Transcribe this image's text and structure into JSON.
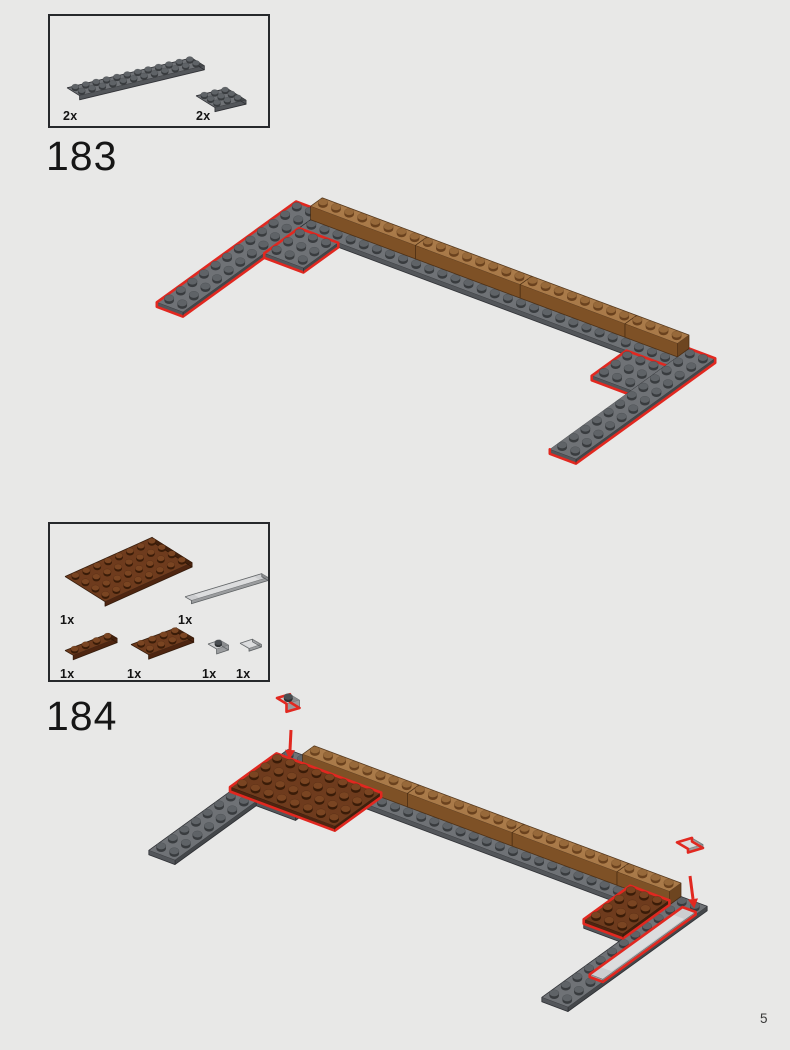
{
  "page": {
    "number": "5",
    "background": "#e8e8e7"
  },
  "steps": [
    {
      "number": "183",
      "parts": [
        {
          "count": "2x",
          "part": "plate-2x12-dark-gray"
        },
        {
          "count": "2x",
          "part": "plate-3x3-dark-gray"
        }
      ]
    },
    {
      "number": "184",
      "parts": [
        {
          "count": "1x",
          "part": "plate-4x8-reddish-brown"
        },
        {
          "count": "1x",
          "part": "tile-1x8-light-gray"
        },
        {
          "count": "1x",
          "part": "plate-1x4-reddish-brown"
        },
        {
          "count": "1x",
          "part": "plate-2x4-reddish-brown"
        },
        {
          "count": "1x",
          "part": "plate-1x1-light-gray"
        },
        {
          "count": "1x",
          "part": "tile-1x1-light-gray"
        }
      ]
    }
  ],
  "colors": {
    "red_outline": "#e12820",
    "background": "#e8e8e7",
    "text": "#161616",
    "box_border": "#26282b",
    "bricks": {
      "dg": {
        "top": "#6f7276",
        "sw": "#53565a",
        "se": "#44474a",
        "studSide": "#393c3f",
        "studTop": "#5f6367",
        "edge": "#24262a"
      },
      "ng": {
        "top": "#a97a49",
        "sw": "#7e5126",
        "se": "#6d4520",
        "studSide": "#6b421e",
        "studTop": "#97693a",
        "edge": "#492c12"
      },
      "rb": {
        "top": "#6e3b1d",
        "sw": "#4e2510",
        "se": "#41200c",
        "studSide": "#3a1c08",
        "studTop": "#7a4522",
        "edge": "#2b1405"
      },
      "lg": {
        "top": "#cdced0",
        "sw": "#9a9c9e",
        "se": "#8a8c8e",
        "studSide": "#8e9092",
        "studTop": "#c3c5c7",
        "edge": "#54575a"
      },
      "darkStud": {
        "side": "#2e3133",
        "top": "#4a4e52"
      }
    }
  },
  "scenes": {
    "box183": {
      "o": [
        17,
        76
      ],
      "U": [
        10.4,
        -2.5
      ],
      "V": [
        6.3,
        3.9
      ],
      "ph": 4.2,
      "studR": [
        3.6,
        2.6
      ],
      "studH": 1.9,
      "pieces": [
        {
          "box": [
            0,
            0,
            12,
            2,
            0,
            1
          ],
          "c": "dg",
          "studs": [
            [
              0,
              0,
              11,
              1
            ]
          ]
        },
        {
          "box": [
            0,
            0,
            3,
            3,
            0,
            1
          ],
          "c": "dg",
          "o": [
            146,
            84
          ],
          "studs": [
            [
              0,
              0,
              2,
              2
            ]
          ]
        }
      ]
    },
    "box184": {
      "o": [
        15,
        57
      ],
      "U": [
        10.9,
        -4.9
      ],
      "V": [
        10,
        6.3
      ],
      "ph": 4.5,
      "studR": [
        3.8,
        2.8
      ],
      "studH": 2,
      "pieces": [
        {
          "box": [
            0,
            0,
            8,
            4,
            0,
            1
          ],
          "c": "rb",
          "studs": [
            [
              0,
              0,
              7,
              3
            ]
          ]
        },
        {
          "box": [
            0,
            0,
            8,
            1,
            0,
            0.7
          ],
          "c": "lg",
          "o": [
            135,
            76
          ],
          "U": [
            9.6,
            -2.9
          ],
          "V": [
            6.4,
            3.7
          ],
          "smooth": true
        },
        {
          "box": [
            0,
            0,
            4,
            1,
            0,
            1
          ],
          "c": "rb",
          "o": [
            15,
            131
          ],
          "U": [
            11,
            -4.3
          ],
          "V": [
            8.2,
            4.8
          ],
          "studs": [
            [
              0,
              0,
              3,
              0
            ]
          ]
        },
        {
          "box": [
            0,
            0,
            4,
            2,
            0,
            1
          ],
          "c": "rb",
          "o": [
            81,
            125
          ],
          "U": [
            11.3,
            -4.2
          ],
          "V": [
            8.8,
            5.1
          ],
          "studs": [
            [
              0,
              0,
              3,
              1
            ]
          ]
        },
        {
          "box": [
            0,
            0,
            1,
            1,
            0,
            1
          ],
          "c": "lg",
          "o": [
            158,
            125
          ],
          "U": [
            12,
            -4
          ],
          "V": [
            8.6,
            5
          ],
          "ph": 5,
          "studs": [
            [
              0,
              0,
              0,
              0
            ]
          ],
          "studC": "dark",
          "studR": [
            3.6,
            2.6
          ],
          "studH": 2.2
        },
        {
          "box": [
            0,
            0,
            1,
            1,
            0,
            0.6
          ],
          "c": "lg",
          "o": [
            190,
            122
          ],
          "U": [
            12.5,
            -4.2
          ],
          "V": [
            9,
            5.2
          ],
          "smooth": true
        }
      ]
    },
    "a183": {
      "o": [
        156,
        21
      ],
      "U": [
        13.1,
        4.9
      ],
      "V": [
        -11.6,
        8.4
      ],
      "ph": 4.5,
      "studR": [
        4.8,
        3.4
      ],
      "studH": 2.4,
      "pieces": [
        {
          "box": [
            0,
            0,
            2,
            12,
            0,
            1
          ],
          "c": "dg",
          "red": true,
          "studs": [
            [
              0,
              0,
              1,
              11
            ]
          ]
        },
        {
          "box": [
            2,
            0,
            30,
            2,
            0,
            1
          ],
          "c": "dg",
          "studs": [
            [
              2,
              1,
              29,
              1
            ]
          ]
        },
        {
          "box": [
            2,
            2,
            5,
            5,
            0,
            1
          ],
          "c": "dg",
          "red": true,
          "studs": [
            [
              2,
              2,
              4,
              4
            ]
          ]
        },
        {
          "box": [
            27,
            2,
            30,
            5,
            0,
            1
          ],
          "c": "dg",
          "red": true,
          "studs": [
            [
              27,
              2,
              29,
              4
            ]
          ]
        },
        {
          "box": [
            30,
            0,
            32,
            12,
            0,
            1
          ],
          "c": "dg",
          "red": true,
          "openSil": true,
          "studs": [
            [
              30,
              0,
              31,
              11
            ]
          ]
        },
        {
          "box": [
            2,
            0,
            10,
            1,
            1,
            4
          ],
          "c": "ng",
          "studs": [
            [
              2,
              0,
              9,
              0
            ]
          ]
        },
        {
          "box": [
            10,
            0,
            18,
            1,
            1,
            4
          ],
          "c": "ng",
          "studs": [
            [
              10,
              0,
              17,
              0
            ]
          ]
        },
        {
          "box": [
            18,
            0,
            26,
            1,
            1,
            4
          ],
          "c": "ng",
          "studs": [
            [
              18,
              0,
              25,
              0
            ]
          ]
        },
        {
          "box": [
            26,
            0,
            30,
            1,
            1,
            4
          ],
          "c": "ng",
          "studs": [
            [
              26,
              0,
              29,
              0
            ]
          ]
        }
      ]
    },
    "a184": {
      "o": [
        148,
        66
      ],
      "U": [
        13.1,
        4.9
      ],
      "V": [
        -11.6,
        8.4
      ],
      "ph": 4.5,
      "studR": [
        4.8,
        3.4
      ],
      "studH": 2.4,
      "pieces": [
        {
          "box": [
            0,
            0,
            2,
            12,
            0,
            1
          ],
          "c": "dg",
          "studs": [
            [
              0,
              0,
              1,
              11
            ]
          ]
        },
        {
          "box": [
            2,
            0,
            30,
            2,
            0,
            1
          ],
          "c": "dg",
          "studs": [
            [
              2,
              1,
              29,
              1
            ]
          ]
        },
        {
          "box": [
            2,
            2,
            5,
            5,
            0,
            1
          ],
          "c": "dg",
          "studs": [
            [
              2,
              2,
              4,
              4
            ]
          ]
        },
        {
          "box": [
            27,
            2,
            30,
            5,
            0,
            1
          ],
          "c": "dg",
          "studs": [
            [
              27,
              2,
              29,
              4
            ]
          ]
        },
        {
          "box": [
            30,
            0,
            32,
            12,
            0,
            1
          ],
          "c": "dg",
          "openSil": true,
          "studs": [
            [
              30,
              0,
              31,
              11
            ]
          ]
        },
        {
          "box": [
            2,
            0,
            10,
            1,
            1,
            4
          ],
          "c": "ng",
          "studs": [
            [
              2,
              0,
              9,
              0
            ]
          ]
        },
        {
          "box": [
            10,
            0,
            18,
            1,
            1,
            4
          ],
          "c": "ng",
          "studs": [
            [
              10,
              0,
              17,
              0
            ]
          ]
        },
        {
          "box": [
            18,
            0,
            26,
            1,
            1,
            4
          ],
          "c": "ng",
          "studs": [
            [
              18,
              0,
              25,
              0
            ]
          ]
        },
        {
          "box": [
            26,
            0,
            30,
            1,
            1,
            4
          ],
          "c": "ng",
          "studs": [
            [
              26,
              0,
              29,
              0
            ]
          ]
        },
        {
          "box": [
            0,
            1,
            8,
            5,
            1,
            2
          ],
          "c": "rb",
          "red": true,
          "studs": [
            [
              0,
              1,
              7,
              4
            ]
          ]
        },
        {
          "box": [
            27,
            1,
            30,
            5,
            1,
            2
          ],
          "c": "rb",
          "red": true,
          "studs": [
            [
              27,
              1,
              29,
              4
            ]
          ]
        },
        {
          "box": [
            31,
            1,
            32,
            9,
            1,
            1.6
          ],
          "c": "lg",
          "red": true,
          "smooth": true
        },
        {
          "box": [
            0,
            0,
            1,
            1,
            0,
            1
          ],
          "c": "lg",
          "red": true,
          "o": [
            137,
            18
          ],
          "U": [
            13,
            -3.8
          ],
          "V": [
            9.5,
            5.8
          ],
          "ph": 8,
          "studs": [
            [
              0,
              0,
              0,
              0
            ]
          ],
          "studC": "dark",
          "studR": [
            4.4,
            3.1
          ],
          "studH": 2.4
        },
        {
          "arrow": [
            151,
            42,
            150,
            62
          ]
        },
        {
          "box": [
            0,
            0,
            1,
            1,
            0,
            0.6
          ],
          "c": "lg",
          "red": true,
          "o": [
            537,
            158
          ],
          "U": [
            15,
            -4.5
          ],
          "V": [
            11,
            6.5
          ],
          "ph": 6,
          "smooth": true
        },
        {
          "arrow": [
            550,
            188,
            553,
            211
          ]
        }
      ]
    }
  }
}
